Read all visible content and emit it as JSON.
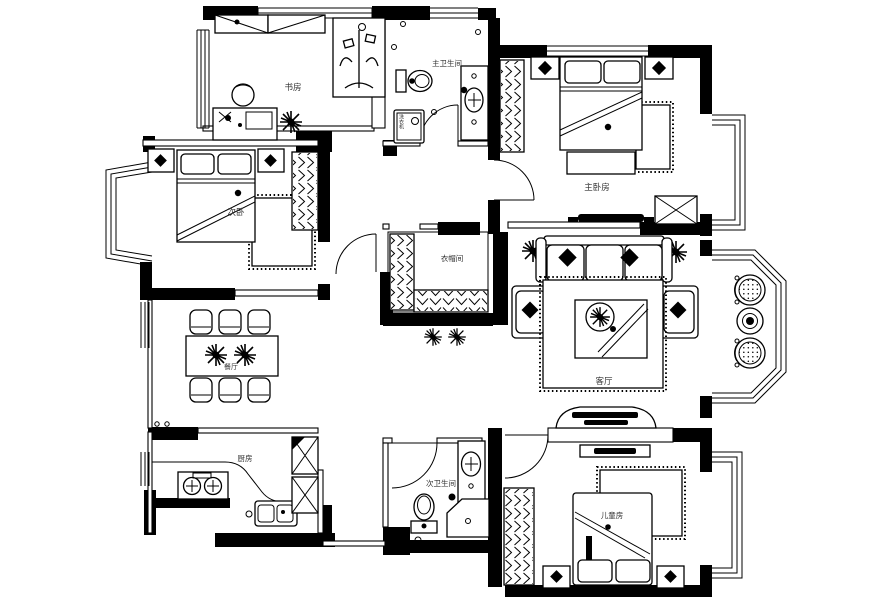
{
  "floorplan": {
    "rooms": {
      "study": {
        "label": "书房"
      },
      "master_bathroom": {
        "label": "主卫生间"
      },
      "master_bedroom": {
        "label": "主卧房"
      },
      "second_bedroom": {
        "label": "次卧"
      },
      "cloakroom": {
        "label": "衣帽间"
      },
      "living_room": {
        "label": "客厅"
      },
      "dining_room": {
        "label": "餐厅"
      },
      "kitchen": {
        "label": "厨房"
      },
      "second_bathroom": {
        "label": "次卫生间"
      },
      "kids_room": {
        "label": "儿童房"
      }
    },
    "appliances": {
      "washing_machine": {
        "label": "洗衣机"
      }
    },
    "colors": {
      "ink": "#000000",
      "paper": "#ffffff",
      "label_text": "#333333"
    }
  }
}
